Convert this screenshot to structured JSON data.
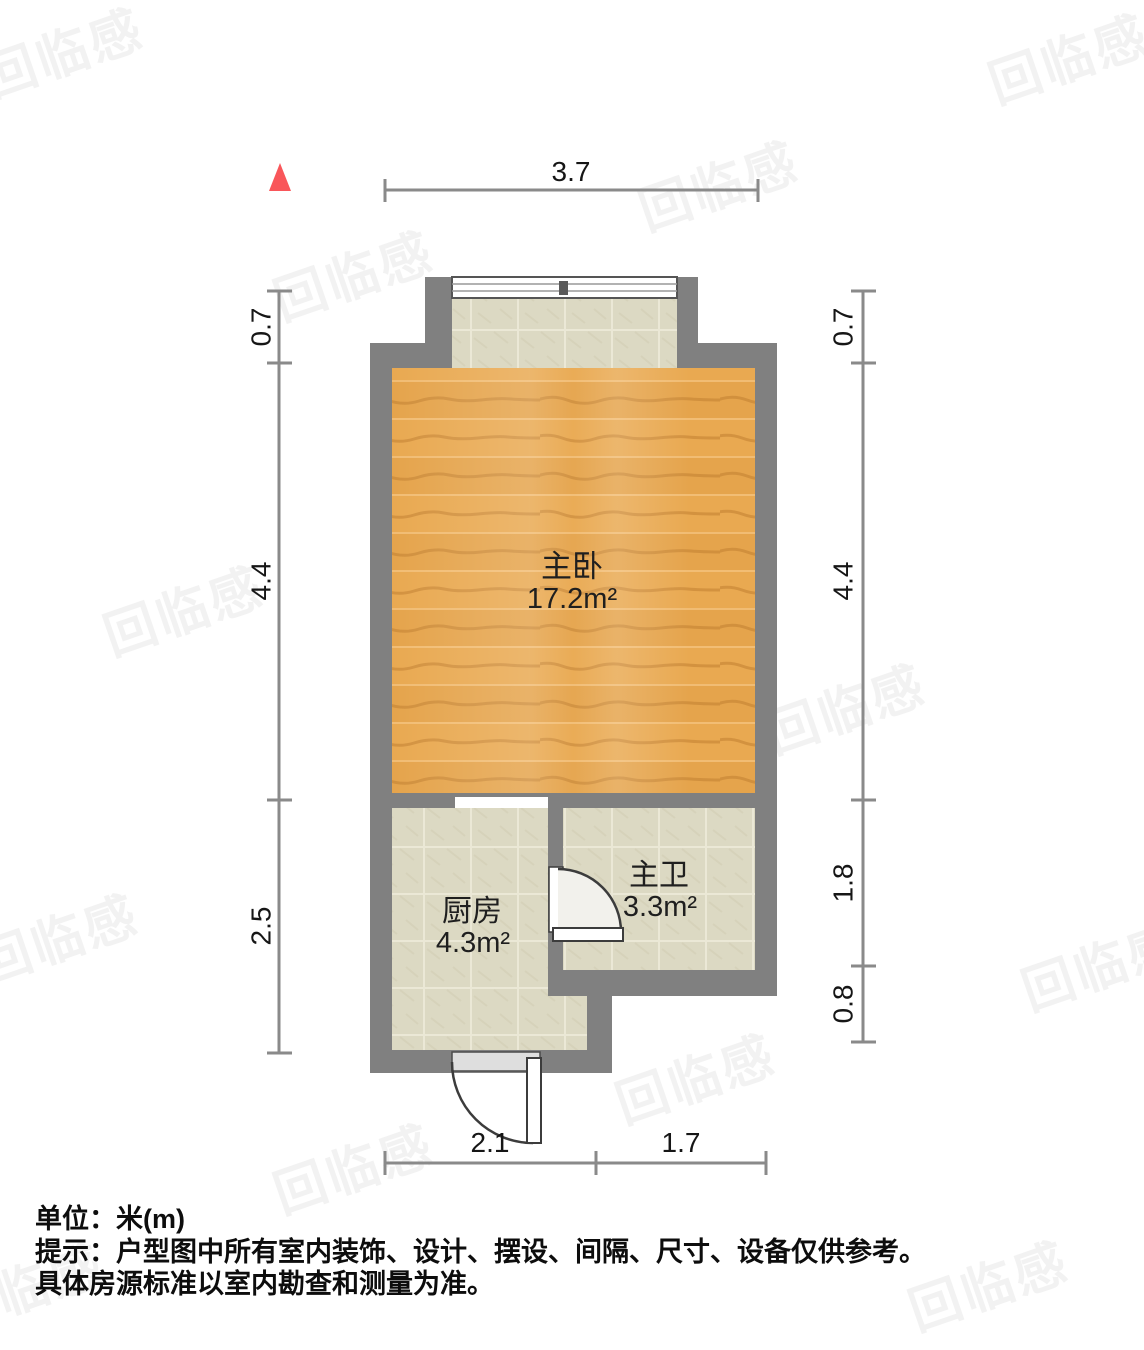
{
  "floorplan": {
    "north_indicator": {
      "symbol": "north-triangle",
      "color": "#f9565a"
    },
    "rooms": [
      {
        "name": "主卧",
        "area": "17.2m²",
        "floor": "wood"
      },
      {
        "name": "厨房",
        "area": "4.3m²",
        "floor": "tile"
      },
      {
        "name": "主卫",
        "area": "3.3m²",
        "floor": "tile"
      }
    ],
    "dimensions": {
      "top": [
        "3.7"
      ],
      "left": [
        "0.7",
        "4.4",
        "2.5"
      ],
      "right": [
        "0.7",
        "4.4",
        "1.8",
        "0.8"
      ],
      "bottom": [
        "2.1",
        "1.7"
      ]
    },
    "colors": {
      "wall": "#808080",
      "wood_floor": "#e5a44c",
      "tile_floor": "#dcd9c3",
      "dimension_line": "#8a8a8a",
      "north_arrow": "#f9565a"
    }
  },
  "footer": {
    "line1": "单位：米(m)",
    "line2": "提示：户型图中所有室内装饰、设计、摆设、间隔、尺寸、设备仅供参考。",
    "line3": "具体房源标准以室内勘查和测量为准。"
  },
  "watermark": {
    "text": "回临感"
  }
}
